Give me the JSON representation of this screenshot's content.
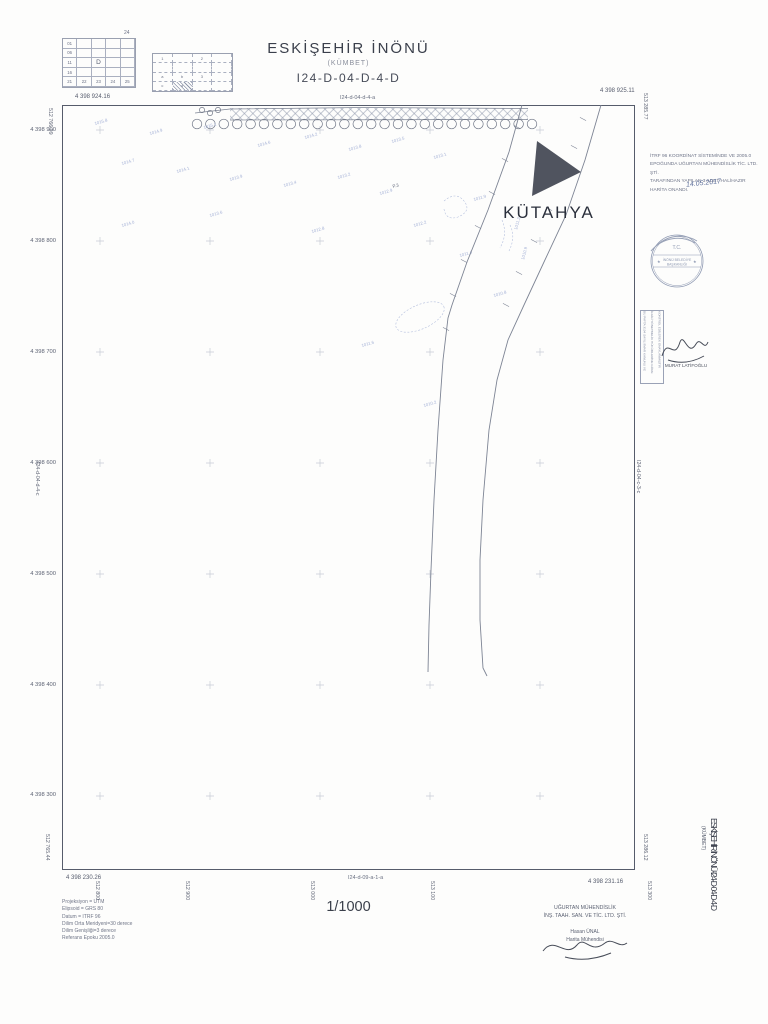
{
  "header": {
    "title": "ESKİŞEHİR İNÖNÜ",
    "subtitle": "(KÜMBET)",
    "sheet_code": "I24-D-04-D-4-D"
  },
  "index": {
    "sheet_no": "24",
    "grid1_col": [
      "01",
      "06",
      "11",
      "16"
    ],
    "grid1_row": [
      "21",
      "22",
      "23",
      "24",
      "25"
    ],
    "grid1_center": "D",
    "grid2_cells": [
      {
        "r": 0,
        "c": 0,
        "t": "1"
      },
      {
        "r": 0,
        "c": 2,
        "t": "2"
      },
      {
        "r": 2,
        "c": 2,
        "t": "3"
      },
      {
        "r": 2,
        "c": 0,
        "t": "a"
      },
      {
        "r": 2,
        "c": 1,
        "t": "b"
      },
      {
        "r": 3,
        "c": 0,
        "t": "c"
      },
      {
        "r": 3,
        "c": 1,
        "t": "d"
      }
    ],
    "grid2_marked": {
      "r": 3,
      "c": 1
    }
  },
  "frame": {
    "corner_tl": "4 398 924.16",
    "corner_tr": "4 398 925.11",
    "corner_bl": "4 398 230.26",
    "corner_br": "4 398 231.16",
    "north_labels": [
      "4 398 900",
      "4 398 800",
      "4 398 700",
      "4 398 600",
      "4 398 500",
      "4 398 400",
      "4 398 300"
    ],
    "east_labels": [
      {
        "x": 100,
        "t": "512 800"
      },
      {
        "x": 190,
        "t": "512 900"
      },
      {
        "x": 315,
        "t": "513 000"
      },
      {
        "x": 435,
        "t": "513 100"
      },
      {
        "x": 652,
        "t": "513 300"
      }
    ],
    "edge_verticals": [
      {
        "x": 53,
        "y": 108,
        "t": "512 766.09"
      },
      {
        "x": 50,
        "y": 834,
        "t": "512 765.44"
      },
      {
        "x": 648,
        "y": 93,
        "t": "513 285.77"
      },
      {
        "x": 648,
        "y": 834,
        "t": "513 286.12"
      }
    ],
    "neighbor_north": "I24-d-04-d-4-a",
    "neighbor_south": "I24-d-09-a-1-a",
    "neighbor_west": "I24-d-04-d-4-c",
    "neighbor_east": "I24-d-04-c-3-c"
  },
  "map": {
    "city_label": "KÜTAHYA",
    "triangle_points": "475,36 519,67 470,91",
    "roads": [
      "M460 0 L447 47 L426 105 L405 157 L390 200 L386 213 L381 255 L376 325 L372 395 L369 465 L367 520 L366 567",
      "M539 0 L523 55 L504 110 L482 157 L462 200 L446 235 L435 275 L427 325 L421 395 L418 455 L418 515 L421 563 L425 571"
    ],
    "trees": {
      "count": 26,
      "x_start": 135,
      "x_end": 470,
      "y": 19,
      "r": 4.8
    },
    "crosses": {
      "xs": [
        38,
        148,
        258,
        368,
        478
      ],
      "ys": [
        25,
        136,
        247,
        358,
        469,
        580,
        691
      ]
    },
    "spots": [
      {
        "x": 33,
        "y": 20,
        "t": "1015.8"
      },
      {
        "x": 88,
        "y": 30,
        "t": "1014.9"
      },
      {
        "x": 142,
        "y": 24,
        "t": "1015.1"
      },
      {
        "x": 196,
        "y": 42,
        "t": "1014.6"
      },
      {
        "x": 243,
        "y": 34,
        "t": "1014.2"
      },
      {
        "x": 287,
        "y": 46,
        "t": "1013.8"
      },
      {
        "x": 330,
        "y": 38,
        "t": "1013.5"
      },
      {
        "x": 372,
        "y": 54,
        "t": "1013.1"
      },
      {
        "x": 60,
        "y": 60,
        "t": "1014.7"
      },
      {
        "x": 115,
        "y": 68,
        "t": "1014.1"
      },
      {
        "x": 168,
        "y": 76,
        "t": "1013.9"
      },
      {
        "x": 222,
        "y": 82,
        "t": "1013.4"
      },
      {
        "x": 276,
        "y": 74,
        "t": "1013.2"
      },
      {
        "x": 318,
        "y": 90,
        "t": "1012.9"
      },
      {
        "x": 148,
        "y": 112,
        "t": "1013.6"
      },
      {
        "x": 60,
        "y": 122,
        "t": "1014.0"
      },
      {
        "x": 250,
        "y": 128,
        "t": "1012.8"
      },
      {
        "x": 352,
        "y": 122,
        "t": "1012.2"
      },
      {
        "x": 412,
        "y": 96,
        "t": "1011.9"
      },
      {
        "x": 331,
        "y": 83,
        "t": "P.3",
        "d": 1
      },
      {
        "x": 398,
        "y": 152,
        "t": "1011.4"
      },
      {
        "x": 432,
        "y": 192,
        "t": "1010.8"
      },
      {
        "x": 300,
        "y": 242,
        "t": "1011.6"
      },
      {
        "x": 362,
        "y": 302,
        "t": "1010.2"
      },
      {
        "x": 455,
        "y": 125,
        "t": "1011.2",
        "rot": -75
      },
      {
        "x": 462,
        "y": 155,
        "t": "1010.9",
        "rot": -75
      }
    ],
    "road_ticks": [
      {
        "x": 521,
        "y": 14
      },
      {
        "x": 512,
        "y": 42
      },
      {
        "x": 500,
        "y": 73
      },
      {
        "x": 487,
        "y": 104
      },
      {
        "x": 472,
        "y": 136
      },
      {
        "x": 457,
        "y": 168
      },
      {
        "x": 444,
        "y": 200
      },
      {
        "x": 455,
        "y": 22
      },
      {
        "x": 443,
        "y": 55
      },
      {
        "x": 430,
        "y": 88
      },
      {
        "x": 416,
        "y": 122
      },
      {
        "x": 402,
        "y": 156
      },
      {
        "x": 391,
        "y": 190
      },
      {
        "x": 384,
        "y": 224
      }
    ]
  },
  "approval": {
    "lines": [
      "İTRF 96 KOORDİNAT SİSTEMİNDE VE 2005.0",
      "EPOĞUNDA UĞURTAN MÜHENDİSLİK TİC. LTD. ŞTİ.",
      "TARAFINDAN YAPILAN 3 ADET HALİHAZIR",
      "HARİTA ONANDI."
    ],
    "date": "14.05.2017"
  },
  "stamp": {
    "top": "T.C.",
    "line1": "İNÖNÜ BELEDİYE",
    "line2": "BAŞKANLIĞI"
  },
  "sign_box": {
    "lines": [
      "BU PAFTA 3194 SAYILI İMAR KANUNU VE",
      "İLGİLİ YÖNETMELİK HÜKÜMLERİNE GÖRE",
      "KONTROL EDİLEREK ONAYLANMIŞTIR"
    ],
    "name": "MURAT LATİFOĞLU"
  },
  "footer": {
    "scale": "1/1000",
    "projection_lines": [
      "Projeksiyon = UTM",
      "Elipsoid = GRS 80",
      "Datum = ITRF 96",
      "Dilim Orta Meridyeni=30 derece",
      "Dilim Genişliği=3 derece",
      "Referans Epoku 2005.0"
    ],
    "company_lines": [
      "UĞURTAN MÜHENDİSLİK",
      "İNŞ. TAAH. SAN. VE TİC. LTD. ŞTİ."
    ],
    "engineer_name": "Hasan ÜNAL",
    "engineer_title": "Harita Mühendisi"
  },
  "side_title": {
    "main": "ESKİŞEHİR İNÖNÜ-I24-D-04-D-4-D",
    "sub": "(KÜMBET)"
  }
}
